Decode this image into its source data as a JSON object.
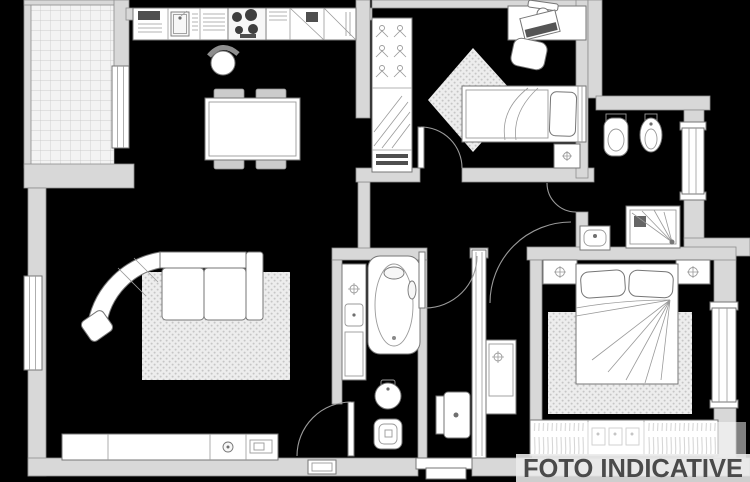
{
  "watermark": {
    "text": "FOTO INDICATIVE"
  },
  "palette": {
    "background": "#000000",
    "wall_fill": "#d8d8d8",
    "wall_stroke": "#8e8e8e",
    "fixture_fill": "#ffffff",
    "fixture_stroke": "#767676",
    "detail_stroke": "#9a9a9a",
    "dark_detail": "#4f4f4f",
    "rug_fill": "#ededed",
    "rug_dot": "#c6c6c6",
    "tile_bg": "#f3f3f3",
    "tile_line": "#c2c2c2",
    "banner_fill": "#ebebeb",
    "banner_text": "#4a4a4a"
  },
  "plan": {
    "type": "apartment-floor-plan",
    "rooms": [
      "balcony",
      "kitchen-dining",
      "living-room",
      "bedroom-2",
      "bathroom-2",
      "hallway",
      "bathroom-1",
      "corridor",
      "master-bedroom",
      "entry"
    ],
    "furniture_icons": [
      "kitchen-counter-icon",
      "kitchen-sink-icon",
      "stove-icon",
      "appliance-icon",
      "dining-table-icon",
      "dining-chair-icon",
      "desk-chair-icon",
      "sofa-icon",
      "rug-icon",
      "tv-sideboard-icon",
      "wardrobe-icon",
      "hanging-clothes-icon",
      "desk-icon",
      "laptop-icon",
      "single-bed-icon",
      "double-bed-icon",
      "pillow-icon",
      "nightstand-icon",
      "lamp-icon",
      "bathtub-icon",
      "toilet-icon",
      "bidet-icon",
      "washbasin-icon",
      "shower-icon",
      "window-icon",
      "door-arc-icon",
      "entry-threshold-icon",
      "balcony-tiles-icon"
    ]
  }
}
